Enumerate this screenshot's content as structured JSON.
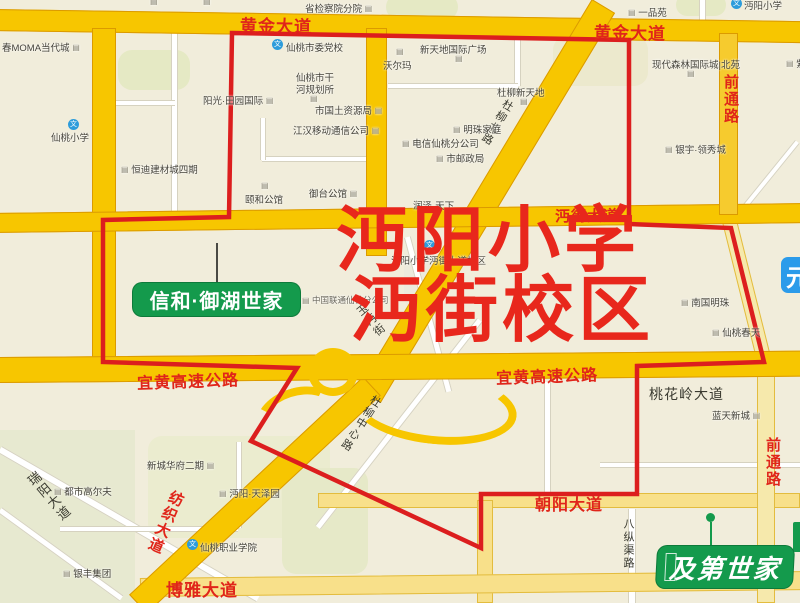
{
  "title": {
    "line1": "沔阳小学",
    "line2": "沔街校区"
  },
  "badges": {
    "estate_left": "信和·御湖世家",
    "estate_bottom": "及第世家",
    "partial_right": "元"
  },
  "roads": [
    "黄金大道",
    "黄金大道",
    "前通路",
    "沔街大道",
    "宜黄高速公路",
    "宜黄高速公路",
    "桃花岭大道",
    "前通路",
    "朝阳大道",
    "博雅大道",
    "纺织大道",
    "瑞阳大道",
    "八纵渠路",
    "杜柳北路",
    "杜柳中心路",
    "玉沔街"
  ],
  "pois": [
    "省检察院分院",
    "一品苑",
    "沔阳小学",
    "春MOMA当代城",
    "仙桃市委党校",
    "新天地国际广场",
    "沃尔玛",
    "仙桃市干",
    "河规划所",
    "杜柳新天地",
    "现代森林国际城|北苑",
    "紫",
    "仙桃小学",
    "阳光·田园国际",
    "市国土资源局",
    "江汉移动通信公司",
    "电信仙桃分公司",
    "明珠家庭",
    "市邮政局",
    "银宇·领秀城",
    "恒迪建材城四期",
    "颐和公馆",
    "御台公馆",
    "润泽·天下",
    "沔阳小学沔街大道校区",
    "中国联通仙桃分公司",
    "南国明珠",
    "仙桃春天",
    "新城华府二期",
    "都市高尔夫",
    "沔阳·天泽园",
    "银丰集团",
    "仙桃职业学院",
    "蓝天新城"
  ],
  "colors": {
    "boundary_red": "#DC1E1E",
    "title_red": "#E8271C",
    "road_label_red": "#E0251A",
    "road_yellow": "#F7C600",
    "road_light_yellow": "#F8E08A",
    "brand_green": "#149A4C",
    "badge_blue": "#2B9BEA",
    "background_beige": "#F1EDDB",
    "school_icon_blue": "#2D9CDB"
  }
}
